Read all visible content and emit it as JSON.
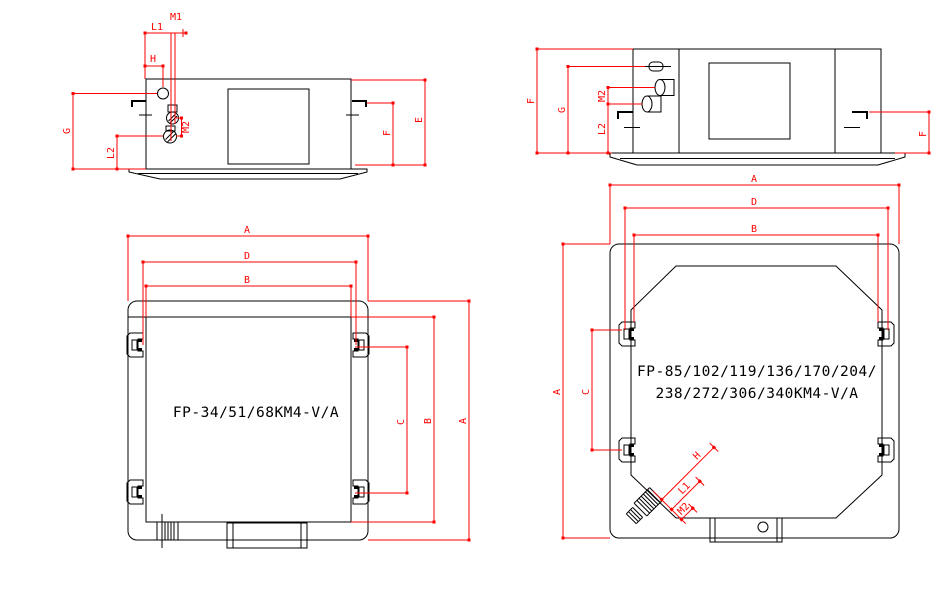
{
  "colors": {
    "line": "#000000",
    "dimension": "#ff0000",
    "background": "#ffffff"
  },
  "views": {
    "side_small": {
      "labels": {
        "m1": "M1",
        "l1": "L1",
        "h": "H",
        "g": "G",
        "l2": "L2",
        "m2": "M2",
        "f": "F",
        "e": "E"
      }
    },
    "side_large": {
      "labels": {
        "f_left": "F",
        "g": "G",
        "m2": "M2",
        "l2": "L2",
        "f_right": "F"
      }
    },
    "plan_small": {
      "model": "FP-34/51/68KM4-V/A",
      "dims": {
        "top_a": "A",
        "top_d": "D",
        "top_b": "B",
        "right_c": "C",
        "right_b": "B",
        "right_a": "A"
      }
    },
    "plan_large": {
      "model_line1": "FP-85/102/119/136/170/204/",
      "model_line2": "238/272/306/340KM4-V/A",
      "dims": {
        "top_a": "A",
        "top_d": "D",
        "top_b": "B",
        "left_a": "A",
        "left_c": "C",
        "pipe_h": "H",
        "pipe_l1": "L1",
        "pipe_m2": "M2"
      }
    }
  }
}
